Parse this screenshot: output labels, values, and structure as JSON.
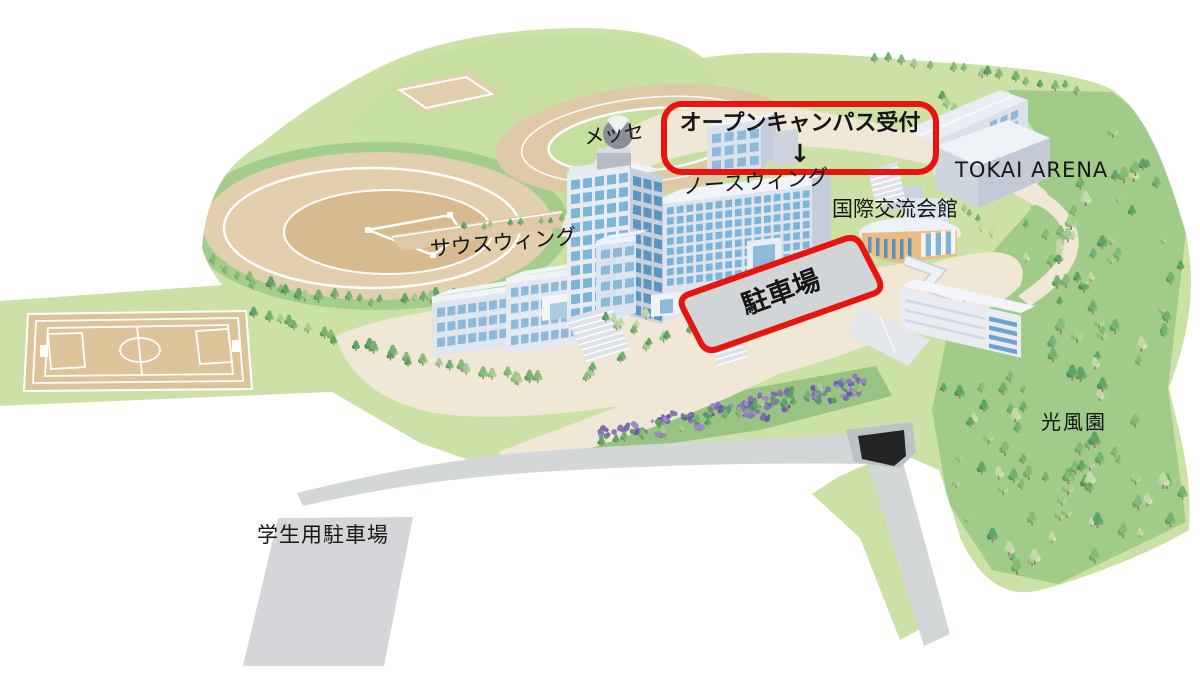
{
  "labels": {
    "messe": "メッセ",
    "south_wing": "サウスウィング",
    "north_wing": "ノースウィング",
    "kokusai_koryu_kaikan": "国際交流会館",
    "tokai_arena": "TOKAI ARENA",
    "kofuen": "光風園",
    "student_parking": "学生用駐車場"
  },
  "annotations": {
    "open_campus_reception": {
      "label": "オープンキャンパス受付",
      "arrow": "↓"
    },
    "parking": {
      "label": "駐車場"
    }
  },
  "colors": {
    "annotation_red": "#e8150f",
    "grass_light": "#cbe1a6",
    "grass_mid": "#a3cd8a",
    "plateau_green": "#c7e0a2",
    "forest_floor": "#a0cb88",
    "sand": "#e2cfae",
    "path_cream": "#f1e7d6",
    "road_gray": "#d3d7d8",
    "building_white": "#ebeff5",
    "window_blue": "#7fb4d9",
    "flower_purple": "#8678b4",
    "kokusai_wall_orange": "#e9bd84"
  }
}
